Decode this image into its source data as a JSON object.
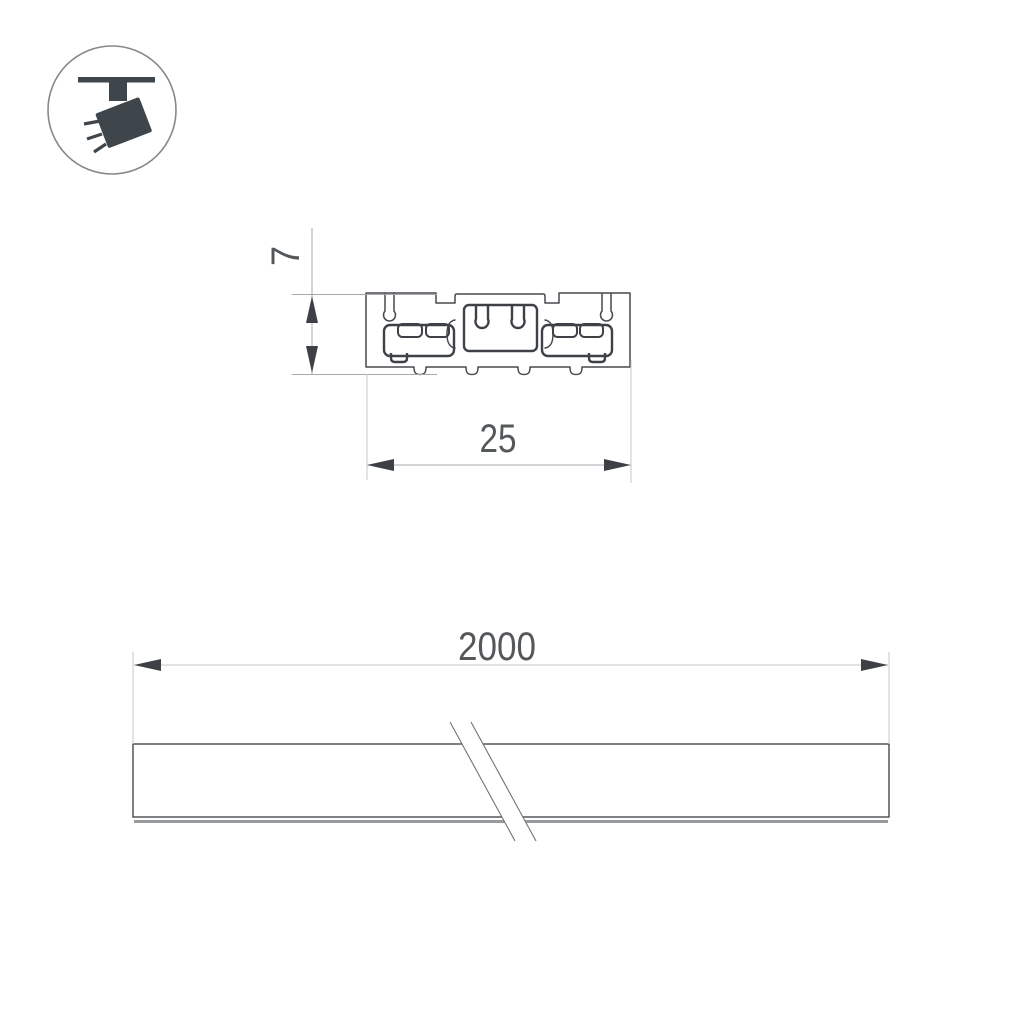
{
  "drawing": {
    "badge": {
      "icon_name": "track-spotlight-icon"
    },
    "cross_section": {
      "height_label": "7",
      "width_label": "25"
    },
    "side_view": {
      "length_label": "2000"
    },
    "colors": {
      "background": "#ffffff",
      "outline": "#46494d",
      "thick_outline": "#3e4246",
      "dimension_line": "#a6a9ac",
      "arrow": "#3d4145",
      "dimension_text": "#55585b",
      "icon": "#3f464b",
      "icon_ring": "#85898d",
      "bottom_flange": "#989b9e"
    }
  }
}
